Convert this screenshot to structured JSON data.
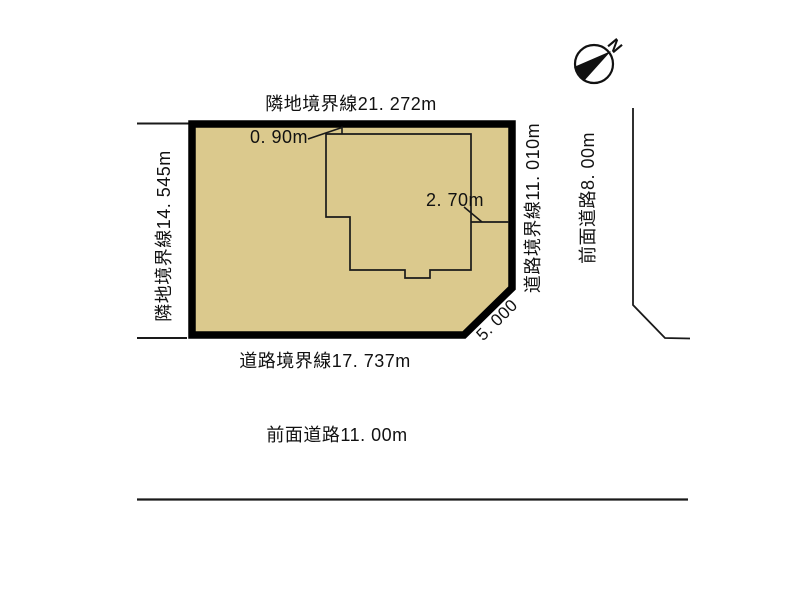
{
  "diagram": {
    "title": "land-plot-site-plan",
    "compass": {
      "north_label": "N"
    },
    "plot": {
      "boundaries": {
        "top": "隣地境界線21. 272m",
        "left": "隣地境界線14. 545m",
        "right": "道路境界線11. 010m",
        "bottom": "道路境界線17. 737m",
        "corner_cut": "5. 000"
      },
      "roads": {
        "right_front_road": "前面道路8. 00m",
        "bottom_front_road": "前面道路11. 00m"
      },
      "building_offsets": {
        "top_gap": "0. 90m",
        "right_gap": "2. 70m"
      }
    },
    "colors": {
      "plot_fill": "#dbc98d",
      "border": "#000000",
      "line": "#1a1a1a"
    }
  }
}
